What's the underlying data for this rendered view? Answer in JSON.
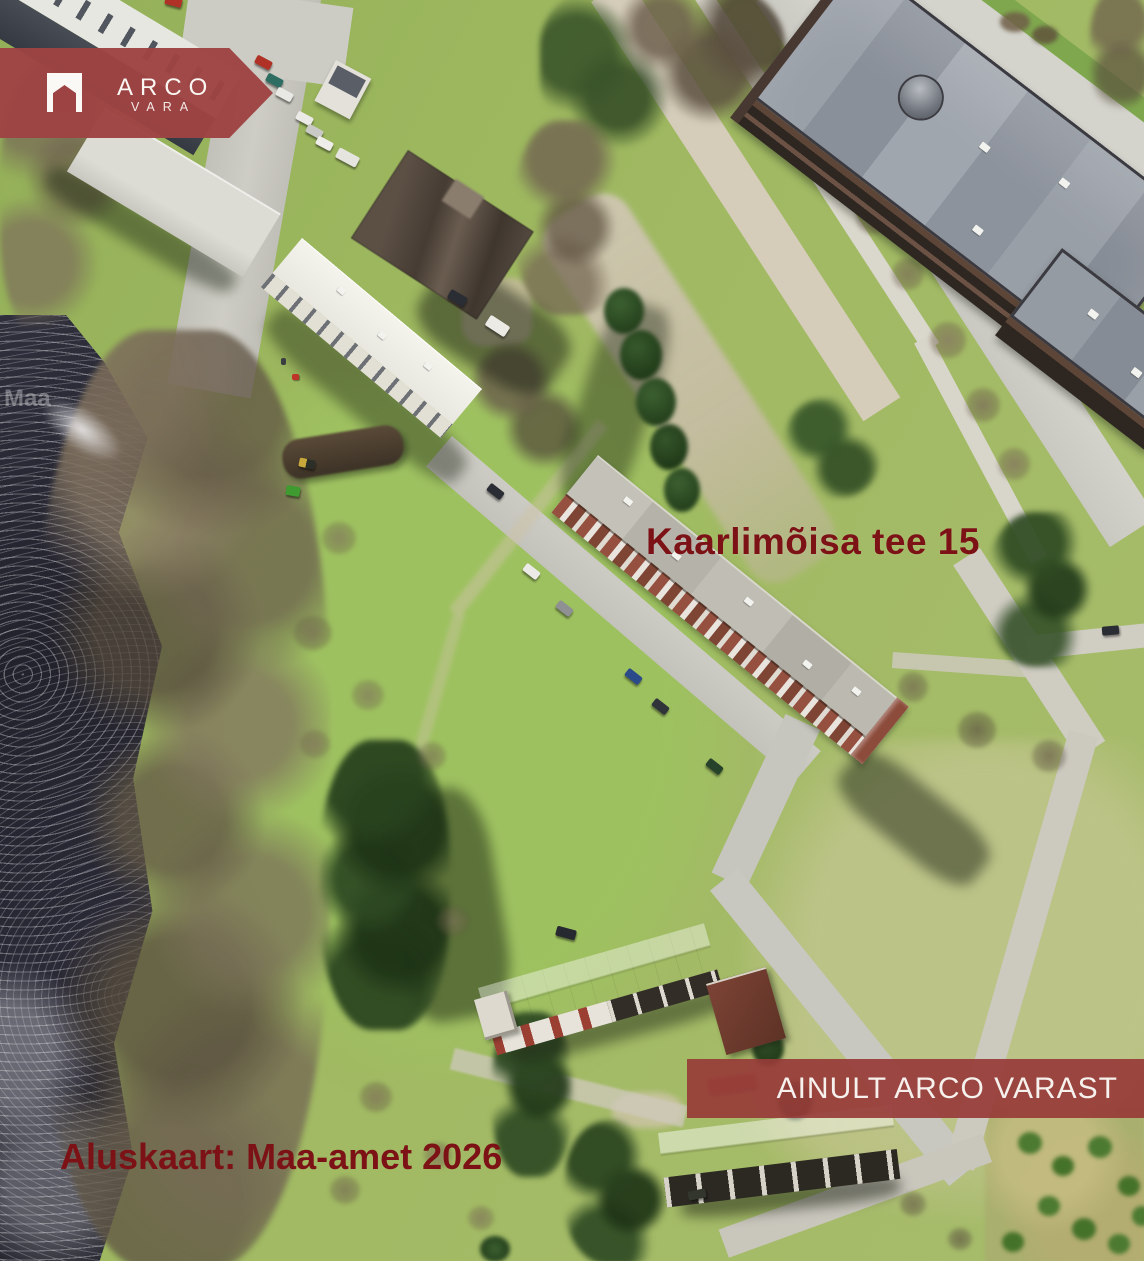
{
  "brand": {
    "logo_text": "ARCO",
    "logo_subtext": "VARA",
    "banner_color": "#9e4343",
    "icon": "arco-house-icon"
  },
  "map": {
    "address_label": "Kaarlimõisa tee 15",
    "basemap_credit": "Aluskaart: Maa-amet 2026",
    "watermark": "Maa",
    "label_color": "#7c1216"
  },
  "badge": {
    "text": "AINULT ARCO VARAST",
    "background": "#973b38",
    "text_color": "#f6f1ed"
  }
}
